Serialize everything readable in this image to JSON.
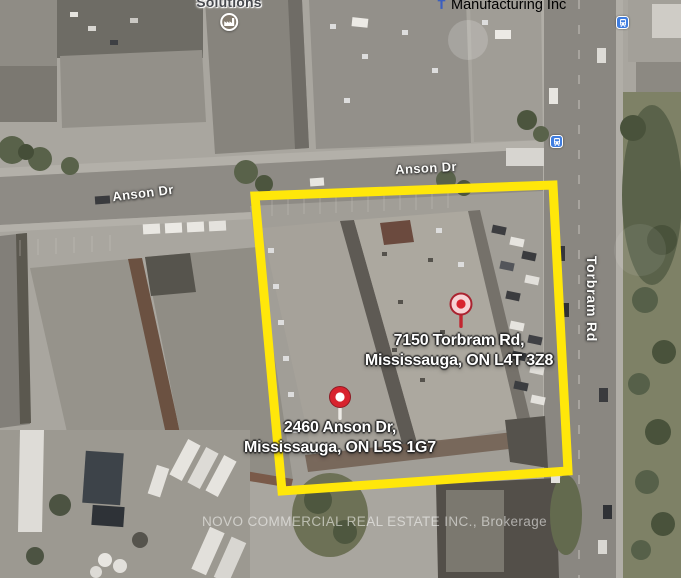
{
  "streets": [
    {
      "name": "Anson Dr"
    },
    {
      "name": "Anson Dr"
    },
    {
      "name": "Torbram Rd"
    }
  ],
  "places": [
    {
      "name": "Solutions",
      "icon": "factory-icon"
    },
    {
      "name": "Manufacturing Inc",
      "icon": "cross-icon"
    }
  ],
  "transit": [
    {
      "icon": "bus-stop-icon"
    },
    {
      "icon": "bus-stop-icon"
    }
  ],
  "markers": [
    {
      "line1": "7150 Torbram Rd,",
      "line2": "Mississauga, ON L4T 3Z8",
      "pin_style": "pink-circle-red-dot"
    },
    {
      "line1": "2460 Anson Dr,",
      "line2": "Mississauga, ON L5S 1G7",
      "pin_style": "red-circle-white-dot"
    }
  ],
  "watermark": "NOVO COMMERCIAL REAL ESTATE INC., Brokerage",
  "colors": {
    "highlight_yellow": "#ffe70a",
    "pin_red": "#d8232e",
    "pin_pink": "#f6d2d5",
    "pin_white": "#ffffff",
    "transit_blue": "#3f7de0"
  }
}
